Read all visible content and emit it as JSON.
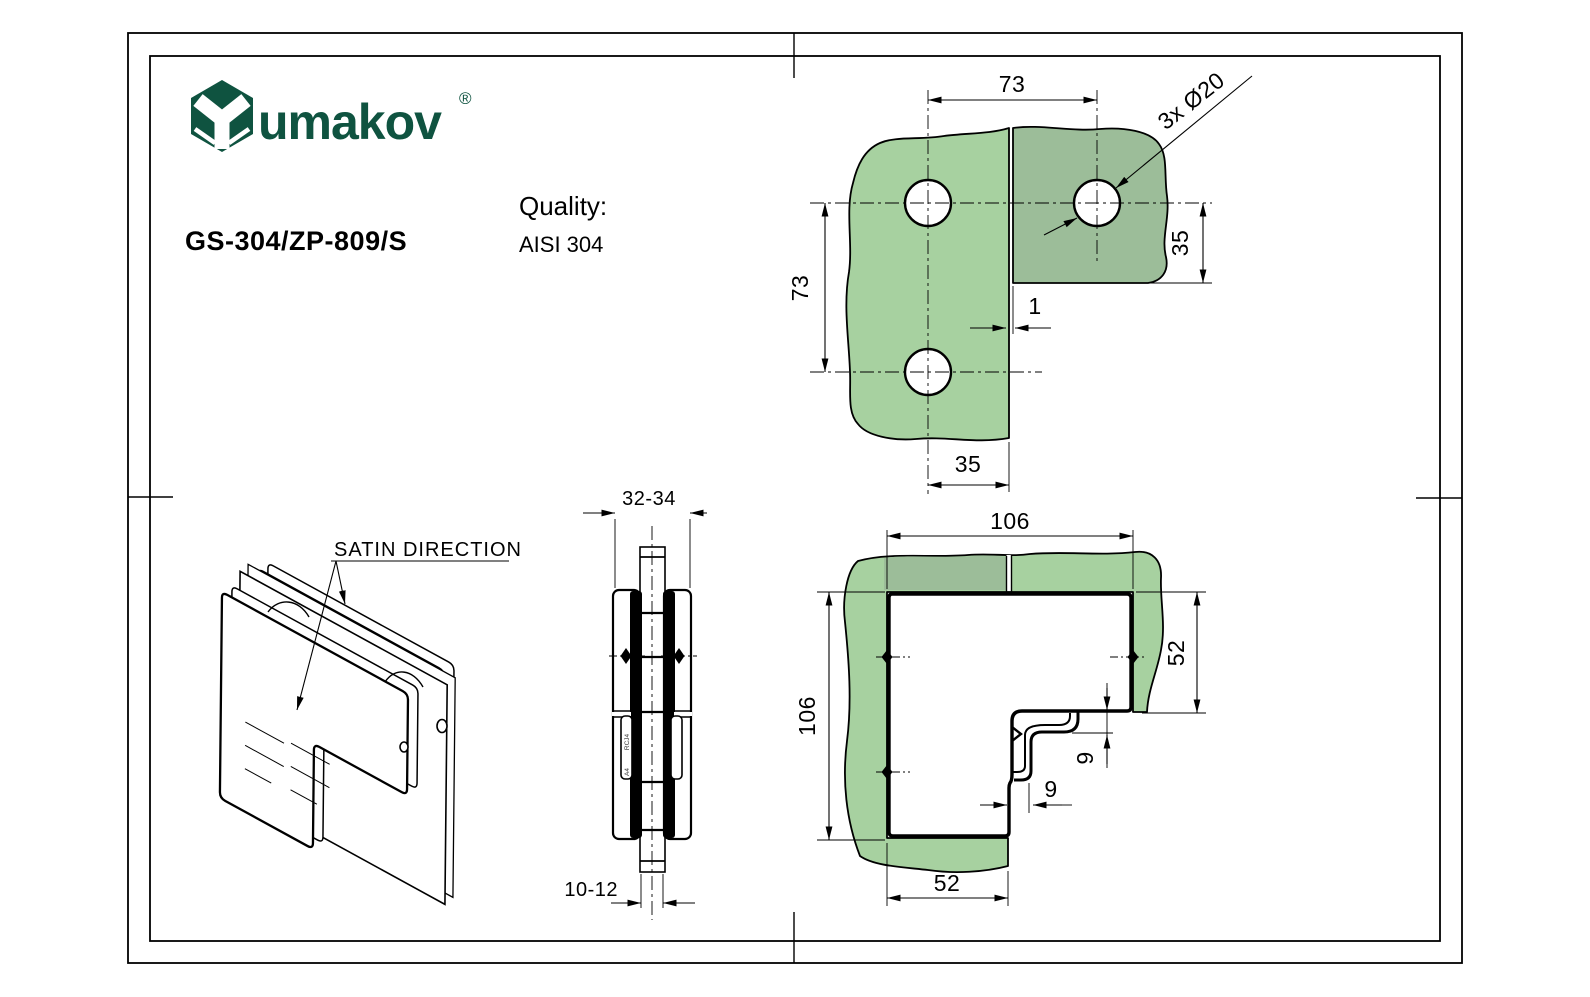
{
  "header": {
    "logo": {
      "text": "umakov",
      "registered": "®"
    },
    "product_code": "GS-304/ZP-809/S",
    "quality_label": "Quality:",
    "quality_value": "AISI 304"
  },
  "colors": {
    "logo_green": "#0f5340",
    "glass_light": "#a7d1a0",
    "glass_dark": "#9cbd99",
    "line_black": "#000000"
  },
  "top_view": {
    "dim_top": "73",
    "dim_left": "73",
    "dim_right": "35",
    "dim_bottom": "35",
    "dim_gap": "1",
    "holes_label": "3x Ø20"
  },
  "side_view": {
    "dim_width": "32-34",
    "dim_glass_thickness": "10-12",
    "cast_mark_upper": "RCJ4",
    "cast_mark_lower": "A4"
  },
  "front_view": {
    "dim_width": "106",
    "dim_height": "106",
    "dim_right_arm": "52",
    "dim_bottom_arm": "52",
    "dim_step_vertical": "9",
    "dim_step_horizontal": "9"
  },
  "iso_view": {
    "label": "SATIN DIRECTION"
  }
}
